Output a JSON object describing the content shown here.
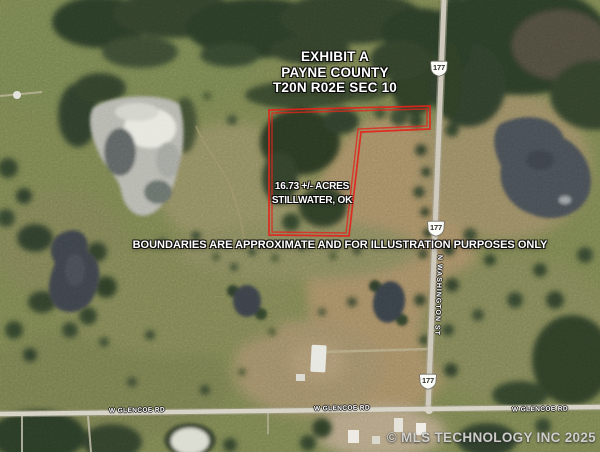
{
  "overlay": {
    "title_line1": "EXHIBIT A",
    "title_line2": "PAYNE COUNTY",
    "title_line3": "T20N R02E SEC 10",
    "parcel_line1": "16.73 +/- ACRES",
    "parcel_line2": "STILLWATER, OK",
    "disclaimer": "BOUNDARIES ARE APPROXIMATE AND FOR ILLUSTRATION PURPOSES ONLY",
    "watermark": "© MLS TECHNOLOGY INC 2025",
    "boundary_color": "#e0261c"
  },
  "roads": {
    "shields": [
      "177",
      "177",
      "177"
    ],
    "vertical_street": "N WASHINGTON ST",
    "glencoe": [
      "W GLENCOE RD",
      "W GLENCOE RD",
      "W GLENCOE RD"
    ]
  }
}
